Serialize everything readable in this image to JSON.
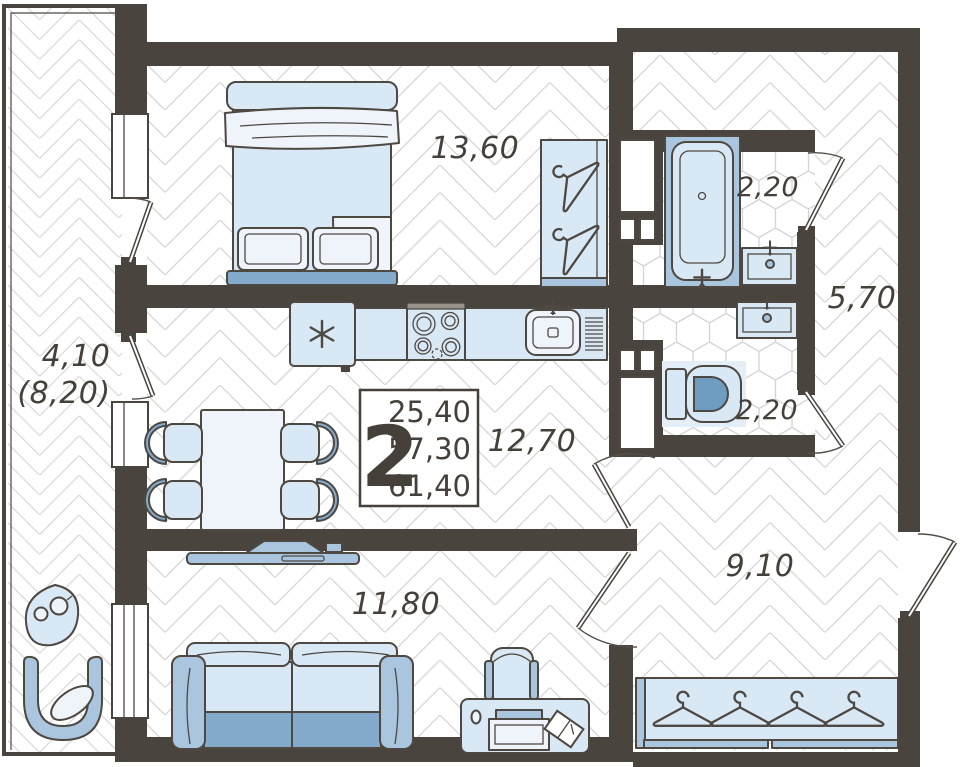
{
  "floorplan": {
    "unit_badge": {
      "rooms_count": "2",
      "area_line_1": "25,40",
      "area_line_2": "57,30",
      "area_line_3": "61,40"
    },
    "labels": {
      "bedroom": "13,60",
      "bathroom": "2,20",
      "hall_top": "5,70",
      "wc": "2,20",
      "kitchen_dining": "12,70",
      "hallway": "9,10",
      "living_room": "11,80",
      "balcony": "4,10",
      "balcony_reduced": "(8,20)"
    },
    "colors": {
      "wall": "#4a443f",
      "outline": "#4e4843",
      "furniture_light": "#d9e8f5",
      "furniture_pale": "#eef4fa",
      "furniture_mid": "#a9c6de",
      "furniture_deep": "#84abcc",
      "floor_line": "#d7d7d7",
      "tile_line": "#d4d4d4",
      "text": "#45403a"
    }
  }
}
